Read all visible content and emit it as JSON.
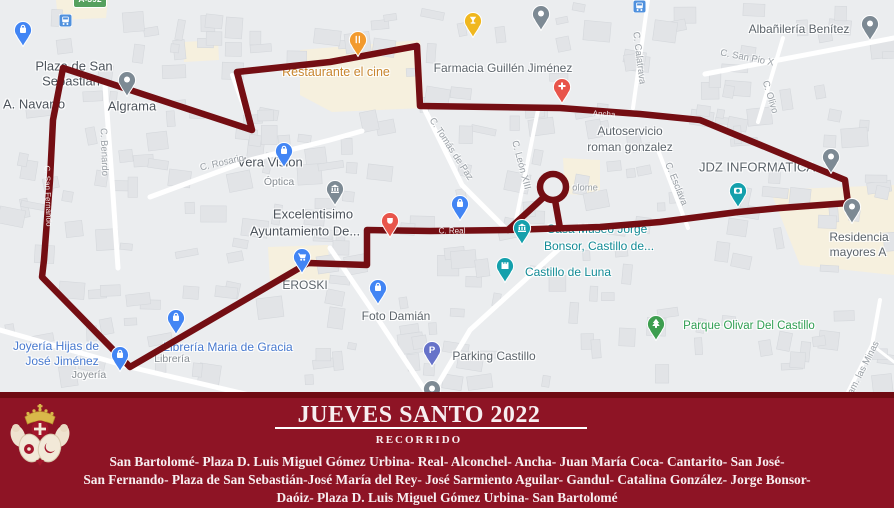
{
  "colors": {
    "route": "#740e13",
    "banner_bg": "#8e1425",
    "banner_strip": "#6f0a12",
    "banner_text": "#f7eef0",
    "map_bg": "#ebedef",
    "building": "#e2e4e7",
    "road": "#ffffff",
    "commercial": "#f7efdc",
    "pin_blue": "#4285f4",
    "pin_teal": "#14a0ac",
    "pin_gray": "#7d8a94",
    "pin_red": "#e8554b",
    "pin_orange": "#f29a2e",
    "pin_yellow": "#f0b71e",
    "pin_green": "#3d9e4f",
    "pin_purple": "#6672c9",
    "label_gray": "#5c646b",
    "label_dark": "#4c535b",
    "label_blue": "#4779cf",
    "label_teal": "#128b96",
    "label_green": "#2f9e52",
    "label_orange": "#c8862f",
    "label_sub": "#868c92",
    "street": "#9aa0a6"
  },
  "map": {
    "road_badge": "A-392",
    "areas": {
      "plaza_line1": "Plaza de San",
      "plaza_line2": "Sebastián",
      "navarro": "A. Navarro"
    },
    "pois": {
      "algrama": {
        "label": "Algrama"
      },
      "restaurante": {
        "label": "Restaurante el cine"
      },
      "farmacia": {
        "label": "Farmacia Guillén Jiménez"
      },
      "autoservicio": {
        "line1": "Autoservicio",
        "line2": "roman gonzalez"
      },
      "jdz": {
        "label": "JDZ INFORMATICA"
      },
      "albanileria": {
        "label": "Albañilería Benítez"
      },
      "veravision": {
        "label": "Vera Vision",
        "sublabel": "Óptica"
      },
      "ayuntamiento": {
        "line1": "Excelentisimo",
        "line2": "Ayuntamiento De..."
      },
      "eroski": {
        "label": "EROSKI"
      },
      "fotodamian": {
        "label": "Foto Damián"
      },
      "casamuseo": {
        "line1": "Casa Museo Jorge",
        "line2": "Bonsor, Castillo de..."
      },
      "castilloluna": {
        "label": "Castillo de Luna"
      },
      "parque": {
        "label": "Parque Olivar Del Castillo"
      },
      "parking": {
        "label": "Parking Castillo"
      },
      "joyeria": {
        "line1": "Joyería Hijas de",
        "line2": "José Jiménez",
        "sublabel": "Joyería"
      },
      "libreria": {
        "label": "Librería Maria de Gracia",
        "sublabel": "Librería"
      },
      "residencia": {
        "line1": "Residencia",
        "line2": "mayores A"
      }
    },
    "streets": {
      "benardo": "C. Benardo",
      "rosario": "C. Rosario",
      "tomas": "C. Tomás de Paz",
      "leon": "C. León XIII",
      "esclava": "C. Esclava",
      "calatrava": "C. Calatrava",
      "sanpio": "C. San Pio X",
      "olivo": "C. Olivo",
      "minas": "Cam. las Minas",
      "bartolome_partial": "olome",
      "ancha": "Ancha",
      "real": "C. Real",
      "sanfernando": "C. San Fernando"
    }
  },
  "banner": {
    "title": "JUEVES SANTO 2022",
    "subtitle": "RECORRIDO",
    "line1": "San Bartolomé- Plaza D. Luis Miguel Gómez Urbina- Real- Alconchel- Ancha- Juan María Coca- Cantarito- San José-",
    "line2": "San Fernando- Plaza de San Sebastián-José María del Rey- José Sarmiento Aguilar- Gandul- Catalina González- Jorge Bonsor-",
    "line3": "Daóiz- Plaza D. Luis Miguel Gómez Urbina- San Bartolomé"
  }
}
